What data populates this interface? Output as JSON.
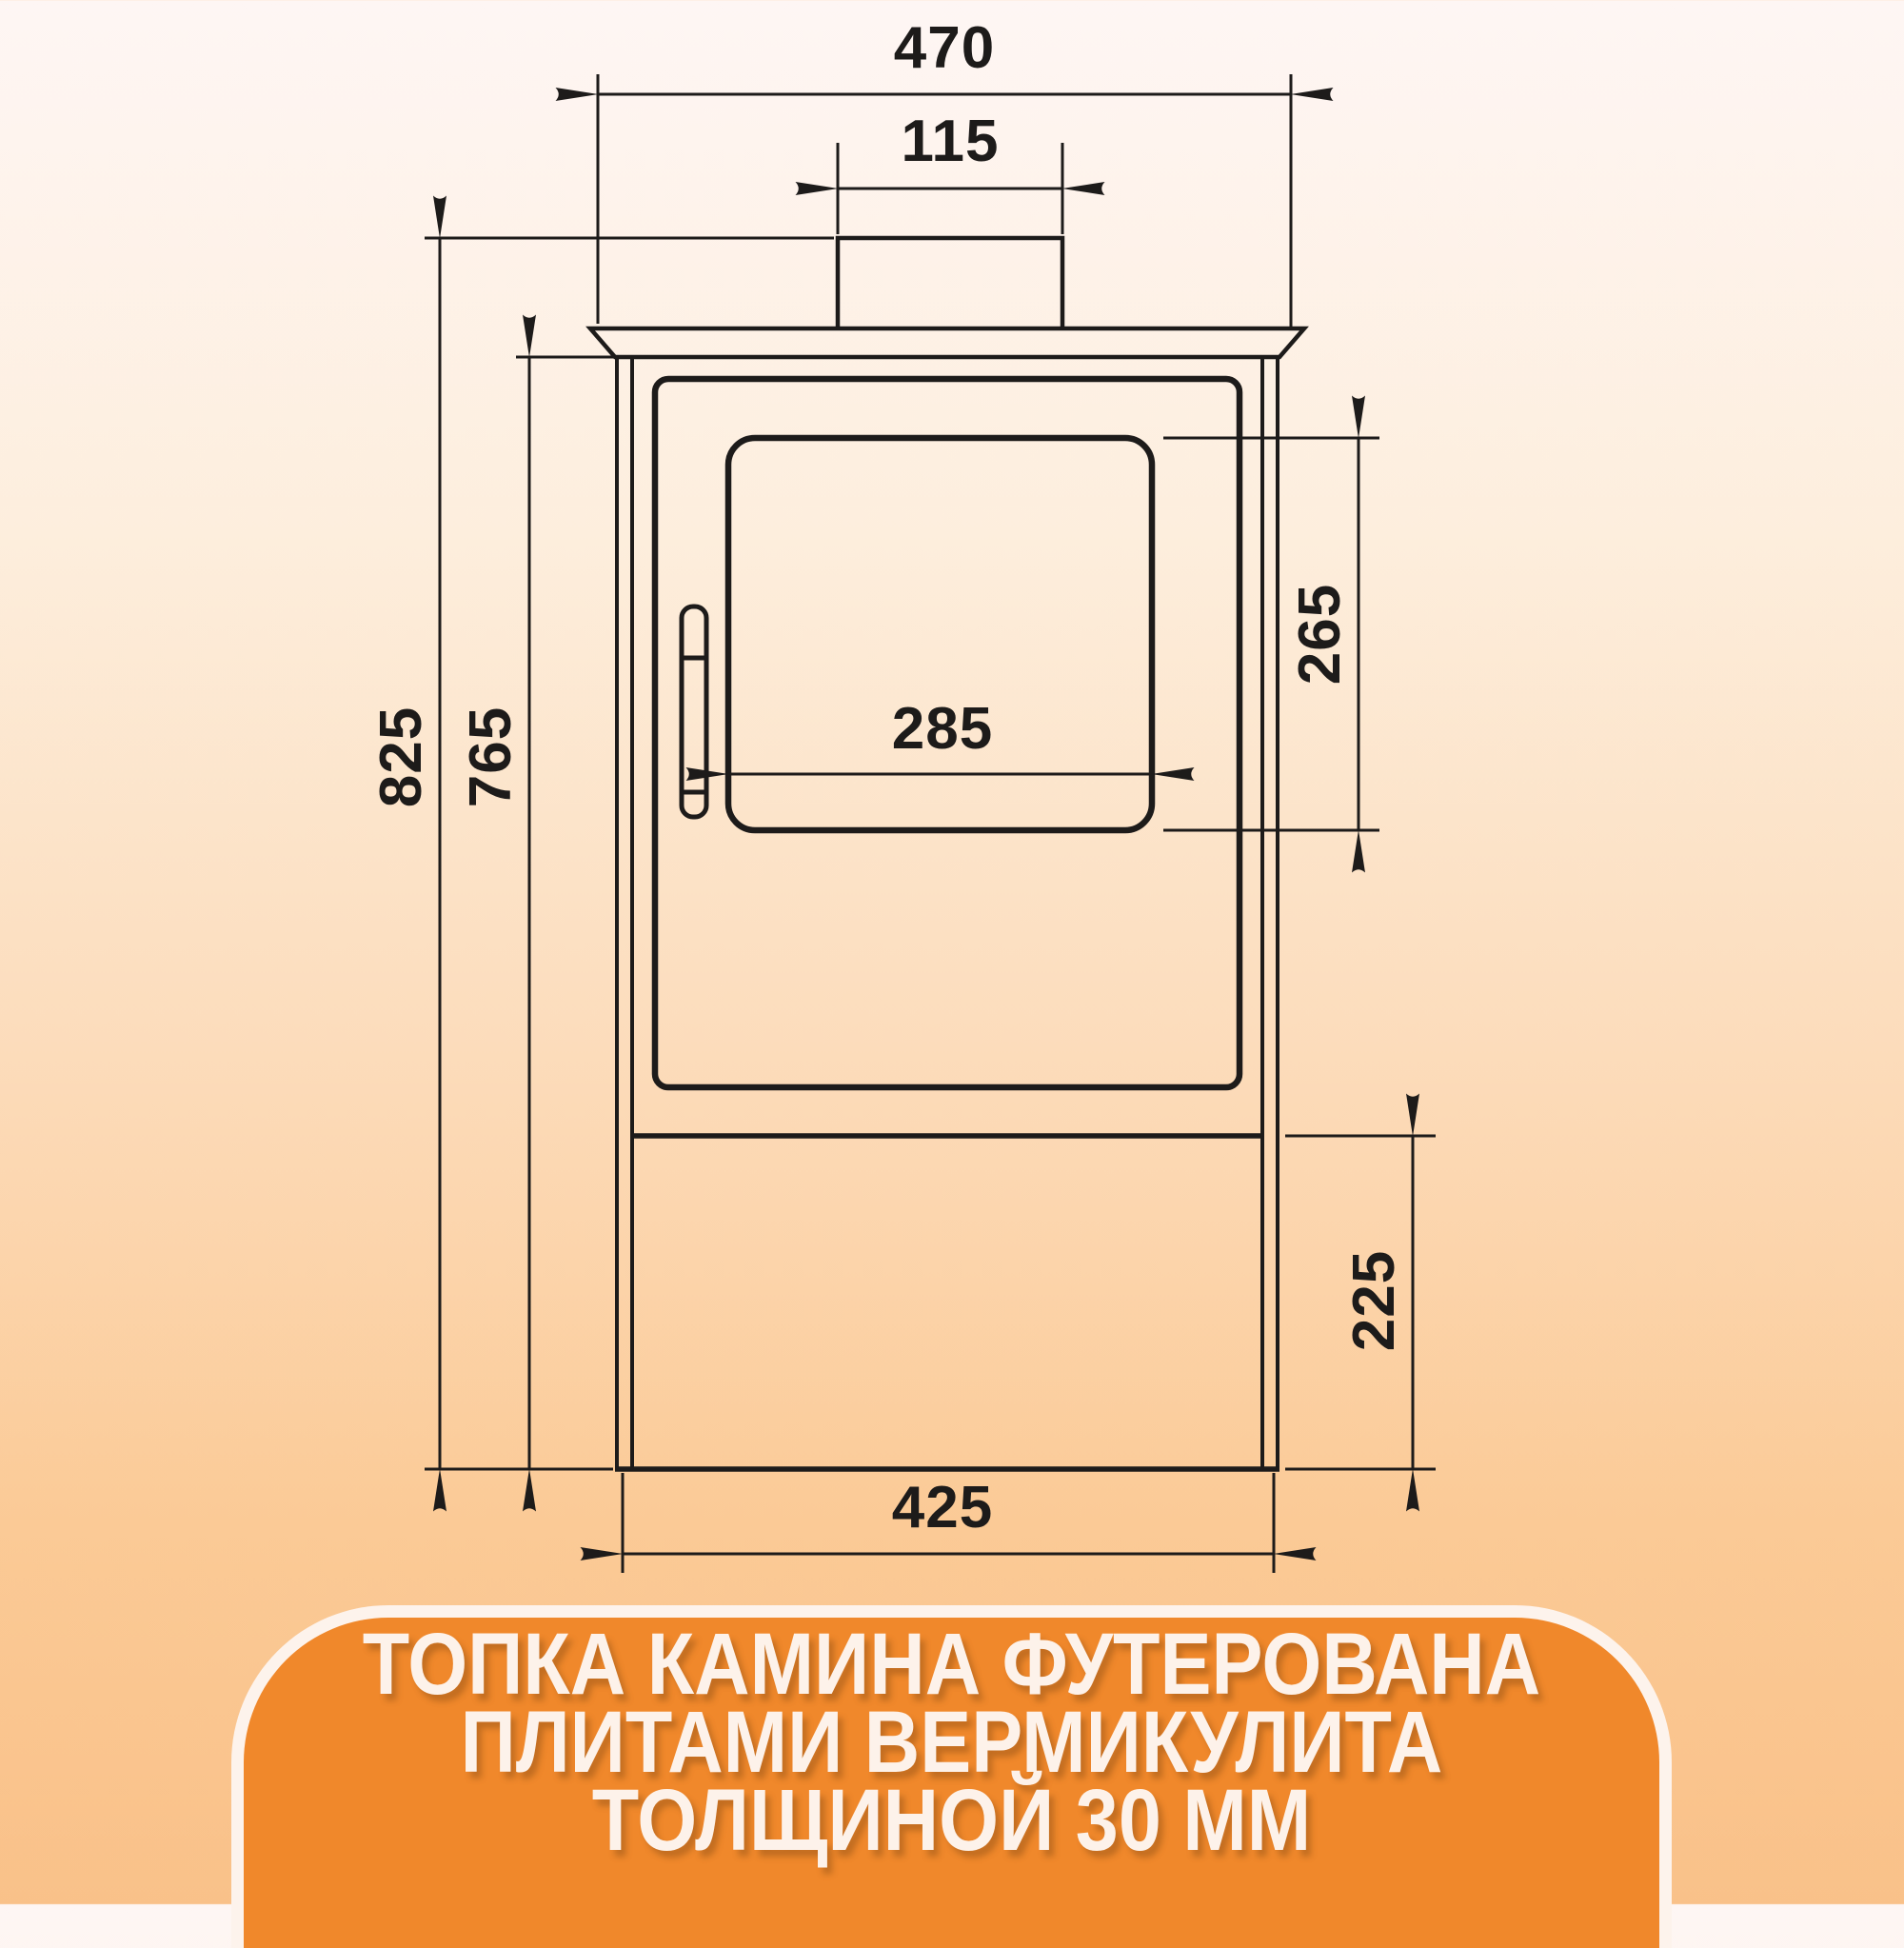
{
  "meta": {
    "background_top_color": "#fef6f4",
    "background_bottom_color": "#f9c189",
    "drawing_line_color": "#1d1b1a"
  },
  "drawing": {
    "type": "front-view technical drawing of a wood-burning stove (fireplace)",
    "units": "mm"
  },
  "dimensions": {
    "top_plate_width": "470",
    "flue_pipe_width": "115",
    "total_height": "825",
    "body_height": "765",
    "glass_height": "265",
    "glass_width": "285",
    "base_height": "225",
    "body_width": "425"
  },
  "banner": {
    "bg_color": "#f0882b",
    "border_color": "#fdf3ec",
    "text_color": "#fdf2ea",
    "line1": "ТОПКА КАМИНА ФУТЕРОВАНА",
    "line2": "ПЛИТАМИ ВЕРМИКУЛИТА",
    "line3": "ТОЛЩИНОЙ 30 ММ"
  }
}
